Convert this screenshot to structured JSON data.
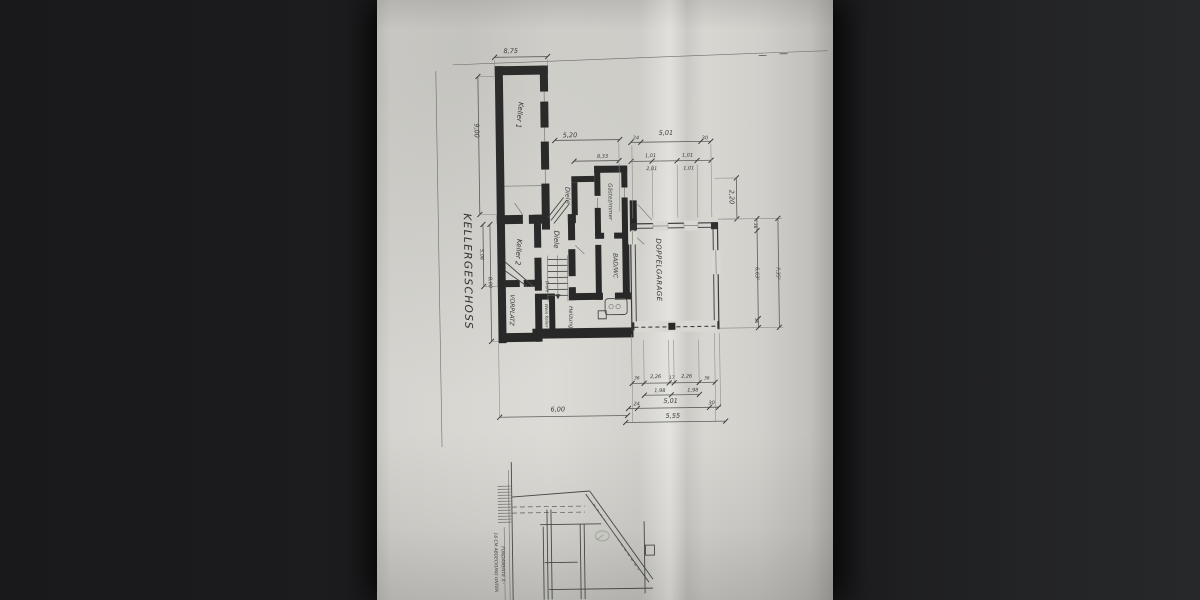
{
  "photo": {
    "background_color": "#1c1c1e",
    "paper_color": "#d8d7d2",
    "ink_color": "#2e2e2e"
  },
  "plan": {
    "title": "KELLERGESCHOSS",
    "rooms": {
      "keller1": "Keller 1",
      "keller2": "Keller 2",
      "diele_top": "Diele",
      "diele_mid": "Diele",
      "diele_small": "Diele",
      "gaestezimmer": "Gästezimmer",
      "bad_wc": "BAD/WC",
      "vorplatz": "VORPLATZ",
      "heizung": "Heizung",
      "weinkeller": "Wein Keller",
      "doppelgarage": "DOPPELGARAGE"
    },
    "dims": {
      "top_width": "8,75",
      "left_height": "9,00",
      "left_inner_a": "5,06",
      "left_inner_b": "8,00",
      "mid_a": "5,20",
      "mid_b": "8,33",
      "chain1": [
        "24",
        "5,01",
        "30"
      ],
      "pairs_top": [
        "1,01",
        "1,01"
      ],
      "pairs_bottom": [
        "2,01",
        "1,01"
      ],
      "right_offset": "2,20",
      "right_wall_top": "36",
      "right_inner": "6,63⁵",
      "right_wall_bottom": "36",
      "right_outer": "7,35⁵",
      "bottom_chain1": [
        "36",
        "2,26",
        "17",
        "2,26",
        "36"
      ],
      "bottom_chain2": [
        "1,98",
        "1,98"
      ],
      "bottom_chain3": [
        "24",
        "5,01",
        "30"
      ],
      "bottom_garage_total": "5,55",
      "bottom_house_total": "6,00"
    },
    "section": {
      "note1": "16 CM ABDECKUNG UNTER",
      "note2": "FUNDAMENTE 3.-"
    }
  }
}
